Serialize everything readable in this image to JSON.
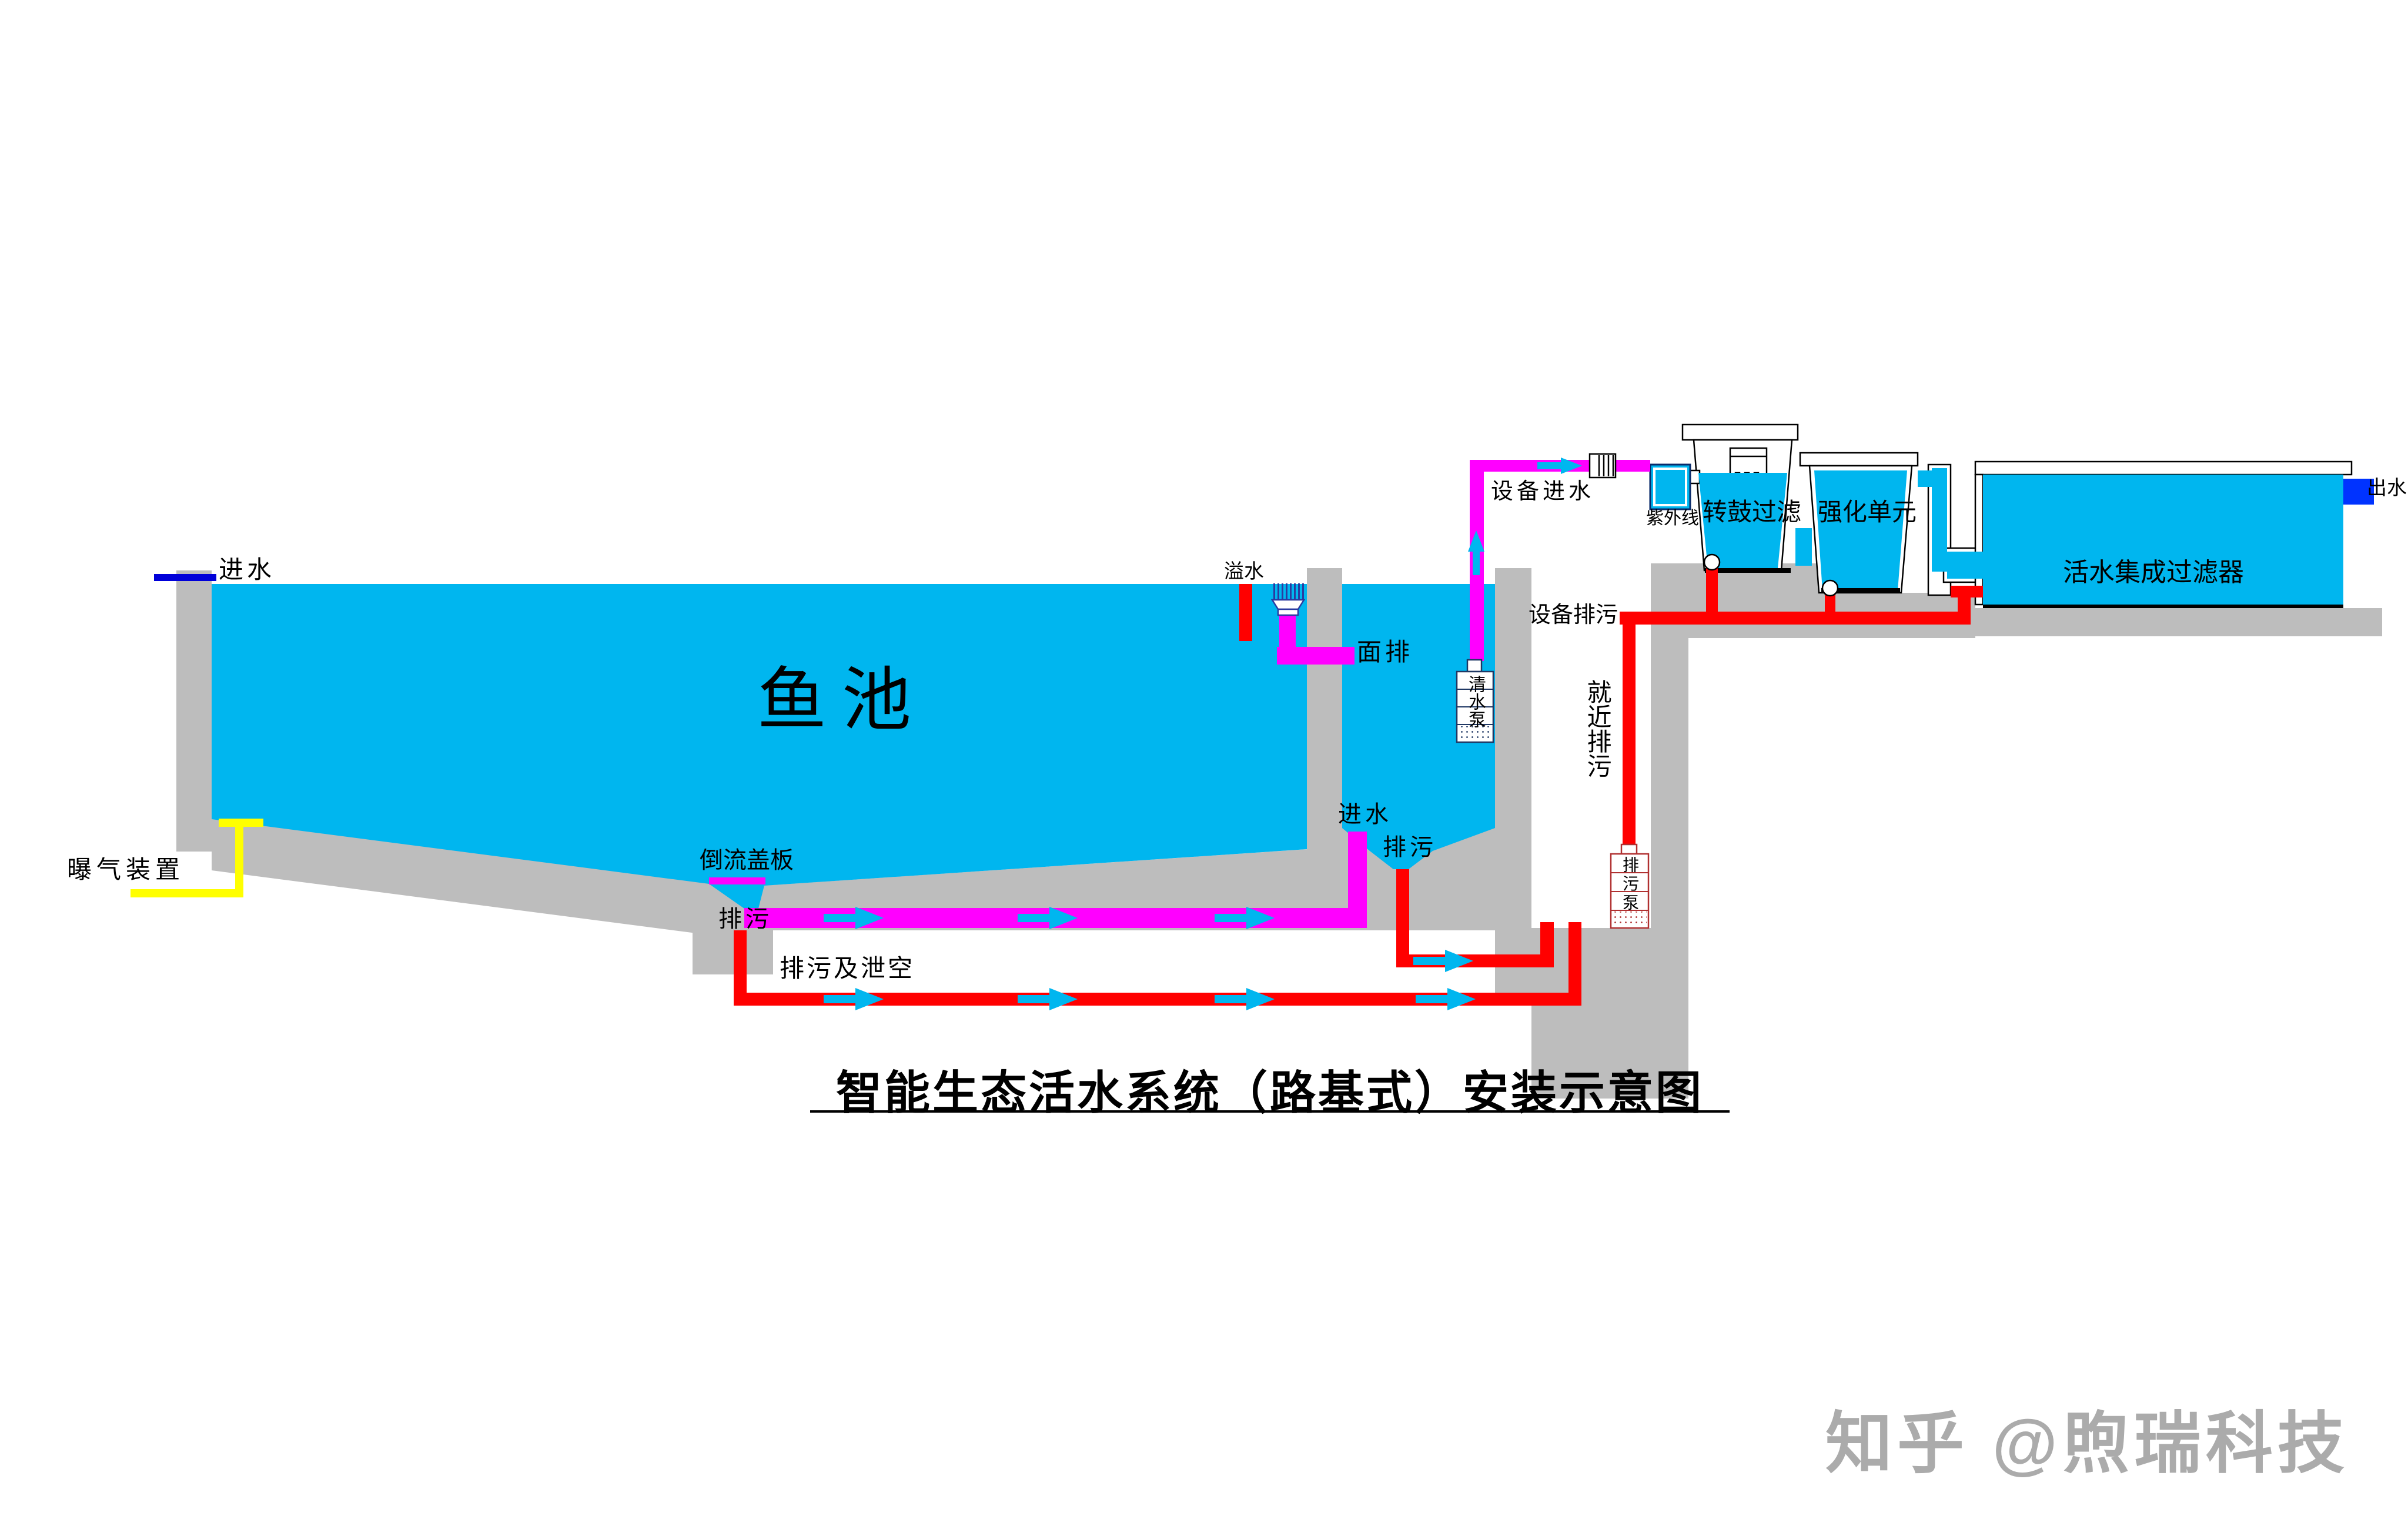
{
  "title": "智能生态活水系统（路基式）安装示意图",
  "watermark": "知乎 @煦瑞科技",
  "labels": {
    "pond_inlet": "进水",
    "pond_name": "鱼池",
    "aerator": "曝气装置",
    "overflow": "溢水",
    "surface_drain": "面排",
    "backflow_cover": "倒流盖板",
    "pond_drain": "排污",
    "drain_and_empty": "排污及泄空",
    "chamber_inlet": "进水",
    "chamber_drain": "排污",
    "clean_pump": "清水泵",
    "equipment_inlet": "设备进水",
    "uv": "紫外线",
    "drum_filter": "转鼓过滤",
    "intensify_unit": "强化单元",
    "integrated_filter": "活水集成过滤器",
    "outlet": "出水",
    "equipment_drain": "设备排污",
    "nearby_drain": "就近排污",
    "drain_pump": "排污泵"
  },
  "colors": {
    "water": "#00B6EF",
    "concrete": "#BDBDBD",
    "drain_pipe": "#FF0000",
    "clean_pipe": "#FF00FF",
    "aeration_pipe": "#FFFF00",
    "inlet_marker": "#0000D9",
    "outlet_marker": "#0033FF",
    "pump_navy": "#1F3864",
    "pump_red": "#B03030",
    "skimmer": "#2B3AA0",
    "watermark": "#ABABAB"
  }
}
